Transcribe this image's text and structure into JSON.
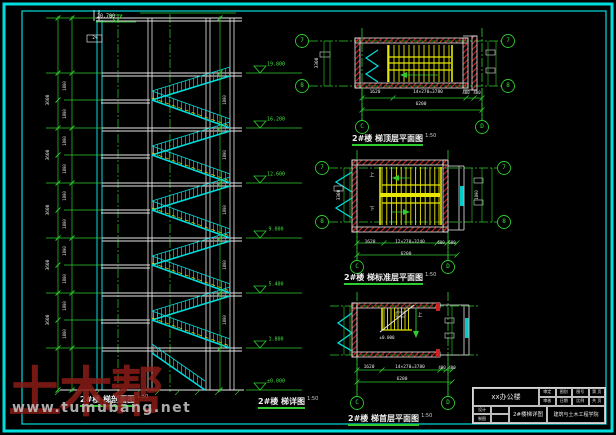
{
  "watermark": {
    "brand": "土木帮",
    "site": "www.tumubang.net"
  },
  "captions": {
    "section": {
      "title": "2#楼 梯剖面图",
      "scale": "1:50"
    },
    "detail": {
      "title": "2#楼 梯详图",
      "scale": "1:50"
    },
    "plan_top": {
      "title": "2#楼 梯顶层平面图",
      "scale": "1:50"
    },
    "plan_std": {
      "title": "2#楼 梯标准层平面图",
      "scale": "1:50"
    },
    "plan_first": {
      "title": "2#楼 梯首层平面图",
      "scale": "1:50"
    }
  },
  "title_block": {
    "project": "xx办公楼",
    "drawing": "2#楼梯详图",
    "school": "建筑与土木工程学院",
    "top_cells": [
      "审定",
      "图别",
      "图号",
      "第 页",
      "审核",
      "日期",
      "比例",
      "共 页"
    ],
    "left_cells": [
      "设计",
      "",
      "制图",
      ""
    ]
  },
  "colors": {
    "cyan": "#00dddd",
    "green": "#2ecc2e",
    "yellow": "#e8e800",
    "red": "#cc2222",
    "white": "#e8e8e8"
  },
  "annotations": [
    {
      "t": "20.700",
      "x": 106,
      "y": 17,
      "c": "w",
      "s": 5,
      "n": "elevation-label"
    },
    {
      "t": "2%",
      "x": 95,
      "y": 39,
      "c": "w",
      "s": 4.5,
      "n": "slope-label"
    },
    {
      "t": "19.800",
      "x": 276,
      "y": 65,
      "c": "g",
      "s": 5,
      "n": "elevation-label"
    },
    {
      "t": "16.200",
      "x": 276,
      "y": 120,
      "c": "g",
      "s": 5,
      "n": "elevation-label"
    },
    {
      "t": "12.600",
      "x": 276,
      "y": 175,
      "c": "g",
      "s": 5,
      "n": "elevation-label"
    },
    {
      "t": "9.000",
      "x": 276,
      "y": 230,
      "c": "g",
      "s": 5,
      "n": "elevation-label"
    },
    {
      "t": "5.400",
      "x": 276,
      "y": 285,
      "c": "g",
      "s": 5,
      "n": "elevation-label"
    },
    {
      "t": "1.800",
      "x": 276,
      "y": 340,
      "c": "g",
      "s": 5,
      "n": "elevation-label"
    },
    {
      "t": "±0.000",
      "x": 276,
      "y": 382,
      "c": "g",
      "s": 5,
      "n": "elevation-label"
    },
    {
      "t": "3600",
      "x": 49,
      "y": 100,
      "c": "w",
      "s": 4.5,
      "r": -90,
      "n": "dim-label"
    },
    {
      "t": "3600",
      "x": 49,
      "y": 155,
      "c": "w",
      "s": 4.5,
      "r": -90,
      "n": "dim-label"
    },
    {
      "t": "3600",
      "x": 49,
      "y": 210,
      "c": "w",
      "s": 4.5,
      "r": -90,
      "n": "dim-label"
    },
    {
      "t": "3600",
      "x": 49,
      "y": 265,
      "c": "w",
      "s": 4.5,
      "r": -90,
      "n": "dim-label"
    },
    {
      "t": "3600",
      "x": 49,
      "y": 320,
      "c": "w",
      "s": 4.5,
      "r": -90,
      "n": "dim-label"
    },
    {
      "t": "1800",
      "x": 65,
      "y": 86,
      "c": "w",
      "s": 4,
      "r": -90,
      "n": "dim-label"
    },
    {
      "t": "1800",
      "x": 65,
      "y": 114,
      "c": "w",
      "s": 4,
      "r": -90,
      "n": "dim-label"
    },
    {
      "t": "1800",
      "x": 65,
      "y": 141,
      "c": "w",
      "s": 4,
      "r": -90,
      "n": "dim-label"
    },
    {
      "t": "1800",
      "x": 65,
      "y": 169,
      "c": "w",
      "s": 4,
      "r": -90,
      "n": "dim-label"
    },
    {
      "t": "1800",
      "x": 65,
      "y": 196,
      "c": "w",
      "s": 4,
      "r": -90,
      "n": "dim-label"
    },
    {
      "t": "1800",
      "x": 65,
      "y": 224,
      "c": "w",
      "s": 4,
      "r": -90,
      "n": "dim-label"
    },
    {
      "t": "1800",
      "x": 65,
      "y": 251,
      "c": "w",
      "s": 4,
      "r": -90,
      "n": "dim-label"
    },
    {
      "t": "1800",
      "x": 65,
      "y": 279,
      "c": "w",
      "s": 4,
      "r": -90,
      "n": "dim-label"
    },
    {
      "t": "1800",
      "x": 65,
      "y": 306,
      "c": "w",
      "s": 4,
      "r": -90,
      "n": "dim-label"
    },
    {
      "t": "1800",
      "x": 65,
      "y": 334,
      "c": "w",
      "s": 4,
      "r": -90,
      "n": "dim-label"
    },
    {
      "t": "1800",
      "x": 225,
      "y": 100,
      "c": "w",
      "s": 4,
      "r": -90,
      "n": "dim-label"
    },
    {
      "t": "1800",
      "x": 225,
      "y": 155,
      "c": "w",
      "s": 4,
      "r": -90,
      "n": "dim-label"
    },
    {
      "t": "1800",
      "x": 225,
      "y": 210,
      "c": "w",
      "s": 4,
      "r": -90,
      "n": "dim-label"
    },
    {
      "t": "1800",
      "x": 225,
      "y": 265,
      "c": "w",
      "s": 4,
      "r": -90,
      "n": "dim-label"
    },
    {
      "t": "1800",
      "x": 225,
      "y": 320,
      "c": "w",
      "s": 4,
      "r": -90,
      "n": "dim-label"
    },
    {
      "t": "7",
      "x": 302,
      "y": 41,
      "c": "g",
      "s": 6,
      "n": "grid-bubble-label"
    },
    {
      "t": "8",
      "x": 302,
      "y": 86,
      "c": "g",
      "s": 6,
      "n": "grid-bubble-label"
    },
    {
      "t": "7",
      "x": 508,
      "y": 41,
      "c": "g",
      "s": 6,
      "n": "grid-bubble-label"
    },
    {
      "t": "8",
      "x": 508,
      "y": 86,
      "c": "g",
      "s": 6,
      "n": "grid-bubble-label"
    },
    {
      "t": "C",
      "x": 362,
      "y": 127,
      "c": "g",
      "s": 6,
      "n": "grid-bubble-label"
    },
    {
      "t": "D",
      "x": 482,
      "y": 127,
      "c": "g",
      "s": 6,
      "n": "grid-bubble-label"
    },
    {
      "t": "1620",
      "x": 375,
      "y": 93,
      "c": "w",
      "s": 4.5,
      "n": "dim-label"
    },
    {
      "t": "14×270=3780",
      "x": 428,
      "y": 93,
      "c": "w",
      "s": 4.5,
      "n": "dim-label"
    },
    {
      "t": "400",
      "x": 466,
      "y": 93,
      "c": "w",
      "s": 4,
      "n": "dim-label"
    },
    {
      "t": "400",
      "x": 477,
      "y": 93,
      "c": "w",
      "s": 4,
      "n": "dim-label"
    },
    {
      "t": "6200",
      "x": 421,
      "y": 105,
      "c": "w",
      "s": 4.5,
      "n": "dim-label"
    },
    {
      "t": "3300",
      "x": 318,
      "y": 63,
      "c": "w",
      "s": 4.5,
      "r": -90,
      "n": "dim-label"
    },
    {
      "t": "7",
      "x": 322,
      "y": 168,
      "c": "g",
      "s": 6,
      "n": "grid-bubble-label"
    },
    {
      "t": "8",
      "x": 322,
      "y": 222,
      "c": "g",
      "s": 6,
      "n": "grid-bubble-label"
    },
    {
      "t": "7",
      "x": 504,
      "y": 168,
      "c": "g",
      "s": 6,
      "n": "grid-bubble-label"
    },
    {
      "t": "8",
      "x": 504,
      "y": 222,
      "c": "g",
      "s": 6,
      "n": "grid-bubble-label"
    },
    {
      "t": "C",
      "x": 357,
      "y": 267,
      "c": "g",
      "s": 6,
      "n": "grid-bubble-label"
    },
    {
      "t": "D",
      "x": 448,
      "y": 267,
      "c": "g",
      "s": 6,
      "n": "grid-bubble-label"
    },
    {
      "t": "1620",
      "x": 370,
      "y": 243,
      "c": "w",
      "s": 4.5,
      "n": "dim-label"
    },
    {
      "t": "12×270=3240",
      "x": 410,
      "y": 243,
      "c": "w",
      "s": 4.5,
      "n": "dim-label"
    },
    {
      "t": "600",
      "x": 441,
      "y": 243,
      "c": "w",
      "s": 4,
      "n": "dim-label"
    },
    {
      "t": "600",
      "x": 452,
      "y": 243,
      "c": "w",
      "s": 4,
      "n": "dim-label"
    },
    {
      "t": "6200",
      "x": 406,
      "y": 255,
      "c": "w",
      "s": 4.5,
      "n": "dim-label"
    },
    {
      "t": "3300",
      "x": 340,
      "y": 195,
      "c": "w",
      "s": 4.5,
      "r": -90,
      "n": "dim-label"
    },
    {
      "t": "1800",
      "x": 477,
      "y": 195,
      "c": "w",
      "s": 4,
      "r": -90,
      "n": "dim-label"
    },
    {
      "t": "上",
      "x": 372,
      "y": 176,
      "c": "w",
      "s": 5,
      "n": "stair-direction-label"
    },
    {
      "t": "下",
      "x": 372,
      "y": 210,
      "c": "w",
      "s": 5,
      "n": "stair-direction-label"
    },
    {
      "t": "C",
      "x": 357,
      "y": 403,
      "c": "g",
      "s": 6,
      "n": "grid-bubble-label"
    },
    {
      "t": "D",
      "x": 448,
      "y": 403,
      "c": "g",
      "s": 6,
      "n": "grid-bubble-label"
    },
    {
      "t": "1620",
      "x": 369,
      "y": 368,
      "c": "w",
      "s": 4.5,
      "n": "dim-label"
    },
    {
      "t": "14×270=3780",
      "x": 410,
      "y": 368,
      "c": "w",
      "s": 4.5,
      "n": "dim-label"
    },
    {
      "t": "400",
      "x": 442,
      "y": 368,
      "c": "w",
      "s": 4,
      "n": "dim-label"
    },
    {
      "t": "400",
      "x": 452,
      "y": 368,
      "c": "w",
      "s": 4,
      "n": "dim-label"
    },
    {
      "t": "6200",
      "x": 402,
      "y": 380,
      "c": "w",
      "s": 4.5,
      "n": "dim-label"
    },
    {
      "t": "±0.000",
      "x": 387,
      "y": 338,
      "c": "w",
      "s": 4.2,
      "n": "elevation-label"
    },
    {
      "t": "上",
      "x": 420,
      "y": 316,
      "c": "w",
      "s": 5,
      "n": "stair-direction-label"
    }
  ]
}
